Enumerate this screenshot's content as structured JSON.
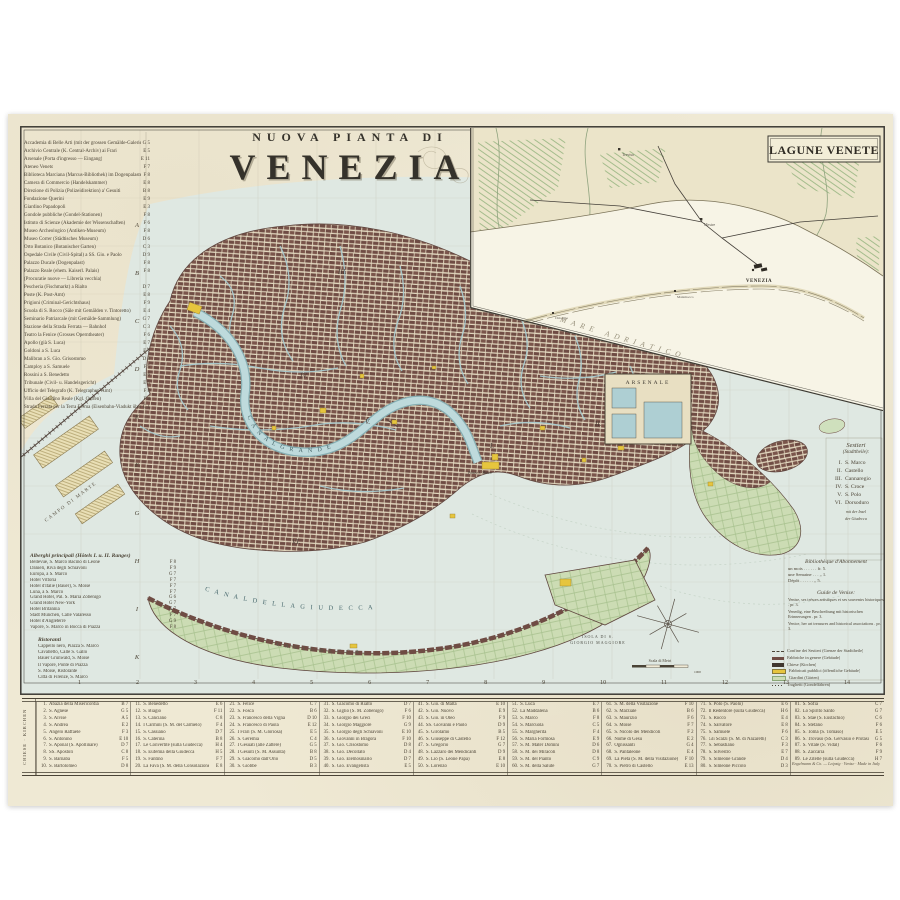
{
  "title": {
    "kicker": "NUOVA PIANTA DI",
    "name": "VENEZIA"
  },
  "inset": {
    "title": "LAGUNE VENETE",
    "sea": "MARE ADRIATICO",
    "city": "VENEZIA",
    "towns": [
      "Treviso",
      "Mestre",
      "Malamocco",
      "Chioggia"
    ]
  },
  "map": {
    "labels": {
      "canal_grande": "C A N A L   G R A N D E",
      "canal_giudecca": "C A N A L   D E L L A   G I U D E C C A",
      "giudecca": "L A   G I U D E C C A",
      "isola1": "ISOLA DI S.",
      "isola2": "GIORGIO MAGGIORE",
      "arsenale": "ARSENALE",
      "campo": "CAMPO DI MARTE",
      "piazza": "Piazza S. Marco",
      "scale": "Scala di Metri",
      "scale_val": "1000"
    },
    "sestieri_marks": {
      "s1": "I.",
      "s2": "II.",
      "s3": "III.",
      "s4": "IV.",
      "s5": "V.",
      "s6": "VI."
    }
  },
  "grid": {
    "numbers": [
      "1",
      "2",
      "3",
      "4",
      "5",
      "6",
      "7",
      "8",
      "9",
      "10",
      "11",
      "12",
      "13",
      "14"
    ],
    "letters": [
      "A",
      "B",
      "C",
      "D",
      "E",
      "F",
      "G",
      "H",
      "I",
      "K"
    ]
  },
  "index_left": {
    "rows": [
      {
        "name": "Accademia di Belle Arti (mit der grossen Gemälde-Galerie)",
        "ref": "G 5"
      },
      {
        "name": "Archivio Centrale (K. Central-Archiv) ai Frari",
        "ref": "E 5"
      },
      {
        "name": "Arsenale (Porta d'ingresso — Eingang)",
        "ref": "E 11"
      },
      {
        "name": "Ateneo Veneto",
        "ref": "F 7"
      },
      {
        "name": "Biblioteca Marciana (Marcus-Bibliothek) im Dogenpalaste",
        "ref": "F 8"
      },
      {
        "name": "Camera di Commercio (Handelskammer)",
        "ref": "E 8"
      },
      {
        "name": "Direzione di Polizia (Polizeidirektion) a' Gesuiti",
        "ref": "B 8"
      },
      {
        "name": "Fondazione Querini",
        "ref": "E 9"
      },
      {
        "name": "Giardino Papadopoli",
        "ref": "E 3"
      },
      {
        "name": "Gondole pubbliche (Gondel-Stationen)",
        "ref": "F 8"
      },
      {
        "name": "Istituto di Scienze (Akademie der Wissenschaften)",
        "ref": "F 6"
      },
      {
        "name": "Museo Archeologico (Antiken-Museum)",
        "ref": "F 8"
      },
      {
        "name": "Museo Correr (Städtisches Museum)",
        "ref": "D 6"
      },
      {
        "name": "Orto Botanico (Botanischer Garten)",
        "ref": "C 3"
      },
      {
        "name": "Ospedale Civile (Civil-Spital) a SS. Gio. e Paolo",
        "ref": "D 9"
      },
      {
        "name": "Palazzo Ducale (Dogenpalast)",
        "ref": "F 8"
      },
      {
        "name": "Palazzo Reale (ehem. Kaiserl. Palais)",
        "ref": "F 8"
      },
      {
        "name": "   (Procuratie nuove — Libreria vecchia)",
        "ref": ""
      },
      {
        "name": "Pescheria (Fischmarkt) a Rialto",
        "ref": "D 7"
      },
      {
        "name": "Poste (K. Post-Amt)",
        "ref": "E 8"
      },
      {
        "name": "Prigioni (Criminal-Gerichtshaus)",
        "ref": "F 9"
      },
      {
        "name": "Scuola di S. Rocco (Säle mit Gemälden v. Tintoretto)",
        "ref": "E 4"
      },
      {
        "name": "Seminario Patriarcale (mit Gemälde-Sammlung)",
        "ref": "G 7"
      },
      {
        "name": "Stazione della Strada Ferrata — Bahnhof",
        "ref": "C 3"
      },
      {
        "name": "Teatro la Fenice (Grosses Operntheater)",
        "ref": "F 6"
      },
      {
        "name": "   Apollo (già S. Luca)",
        "ref": "E 7"
      },
      {
        "name": "   Goldoni a S. Luca",
        "ref": "E 7"
      },
      {
        "name": "   Malibran a S. Gio. Grisostomo",
        "ref": "D 8"
      },
      {
        "name": "   Camploy a S. Samuele",
        "ref": "F 5"
      },
      {
        "name": "   Rossini a S. Benedetto",
        "ref": "E 6"
      },
      {
        "name": "Tribunale (Civil- u. Handelsgericht)",
        "ref": "E 5"
      },
      {
        "name": "Ufficio del Telegrafo (K. Telegraphen-Amt)",
        "ref": "F 8"
      },
      {
        "name": "Villa del Giardino Reale (Kgl. Garten)",
        "ref": "F 8"
      },
      {
        "name": "Strada Ferrata per la Terra Ferma (Eisenbahn-Viadukt über die Lagunen)",
        "ref": "C 1"
      }
    ]
  },
  "hotels": {
    "header": "Alberghi principali (Hôtels I. u. II. Ranges)",
    "rows": [
      {
        "name": "Bellevue, S. Marco Bacino di Leone",
        "ref": "F 8"
      },
      {
        "name": "Danieli, Riva degli Schiavoni",
        "ref": "F 9"
      },
      {
        "name": "Europa, a S. Marco",
        "ref": "G 7"
      },
      {
        "name": "Hôtel Vittoria",
        "ref": "F 7"
      },
      {
        "name": "Hôtel d'Italie (Bauer), S. Moisè",
        "ref": "F 7"
      },
      {
        "name": "Luna, a S. Marco",
        "ref": "F 7"
      },
      {
        "name": "Grand Hôtel, Pal. S. Maria Zobenigo",
        "ref": "G 6"
      },
      {
        "name": "Grand Hôtel New-York",
        "ref": "G 7"
      },
      {
        "name": "Hôtel Britannia",
        "ref": "G 7"
      },
      {
        "name": "Stadt München, Calle Valaresso",
        "ref": "F 7"
      },
      {
        "name": "Hôtel d'Angleterre",
        "ref": "G 9"
      },
      {
        "name": "Vapore, S. Marco in Bocca di Piazza",
        "ref": "F 8"
      }
    ]
  },
  "restaurants": {
    "header": "Ristoranti",
    "rows": [
      "Cappello nero, Piazza S. Marco",
      "Cavalletto, Calle S. Gallo",
      "Bauer Grünwald, S. Moisè",
      "Il Vapore, Ponte di Piazza",
      "S. Moisè, Ristorante",
      "Città di Firenze, S. Marco"
    ]
  },
  "sestieri": {
    "title": "Sestieri",
    "subtitle": "(Stadttheile):",
    "items": [
      {
        "num": "I.",
        "name": "S. Marco"
      },
      {
        "num": "II.",
        "name": "Castello"
      },
      {
        "num": "III.",
        "name": "Cannaregio"
      },
      {
        "num": "IV.",
        "name": "S. Croce"
      },
      {
        "num": "V.",
        "name": "S. Polo"
      },
      {
        "num": "VI.",
        "name": "Dorsoduro"
      }
    ],
    "note1": "mit der Insel",
    "note2": "der Giudecca"
  },
  "library": {
    "title": "Bibliothèque d'Abonnement",
    "rows": [
      "un mois . . . . . . fr. 5.",
      "une Semaine . . . „ 1.",
      "Dépôt . . . . . . „ 5."
    ]
  },
  "guide": {
    "title": "Guide de Venise:",
    "rows": [
      "Venise, ses trésors artistiques et ses souvenirs historiques . pr. 3.",
      "Venedig, eine Beschreibung mit historischen Erinnerungen . pr. 3.",
      "Venice, her art treasures and historical associations . pr. 3."
    ]
  },
  "legend": {
    "items": [
      {
        "sym": "dash",
        "label": "Confine dei Sestieri (Grenze der Stadttheile)"
      },
      {
        "sym": "block",
        "label": "Fabbriche in genere (Gebäude)"
      },
      {
        "sym": "church",
        "label": "Chiese (Kirchen)"
      },
      {
        "sym": "public",
        "label": "Fabbricati pubblici (öffentliche Gebäude)"
      },
      {
        "sym": "garden",
        "label": "Giardini (Gärten)"
      },
      {
        "sym": "dots",
        "label": "Traghetti (Gondelfähren)"
      }
    ]
  },
  "church_table": {
    "side_label": "CHIESE · KIRCHEN",
    "columns": [
      {
        "rows": [
          {
            "n": "1.",
            "name": "Abazia della Misericordia",
            "ref": "B 7"
          },
          {
            "n": "2.",
            "name": "S. Agnese",
            "ref": "G 5"
          },
          {
            "n": "3.",
            "name": "S. Alvise",
            "ref": "A 5"
          },
          {
            "n": "4.",
            "name": "S. Andrea",
            "ref": "E 2"
          },
          {
            "n": "5.",
            "name": "Angelo Raffaele",
            "ref": "F 3"
          },
          {
            "n": "6.",
            "name": "S. Antonino",
            "ref": "E 10"
          },
          {
            "n": "7.",
            "name": "S. Aponal (S. Apollinare)",
            "ref": "D 7"
          },
          {
            "n": "8.",
            "name": "SS. Apostoli",
            "ref": "C 8"
          },
          {
            "n": "9.",
            "name": "S. Barnaba",
            "ref": "F 5"
          },
          {
            "n": "10.",
            "name": "S. Bartolomeo",
            "ref": "D 8"
          }
        ]
      },
      {
        "rows": [
          {
            "n": "11.",
            "name": "S. Benedetto",
            "ref": "E 6"
          },
          {
            "n": "12.",
            "name": "S. Biagio",
            "ref": "F 11"
          },
          {
            "n": "13.",
            "name": "S. Canciano",
            "ref": "C 8"
          },
          {
            "n": "14.",
            "name": "I Carmini (S. M. del Carmelo)",
            "ref": "F 4"
          },
          {
            "n": "15.",
            "name": "S. Cassiano",
            "ref": "D 7"
          },
          {
            "n": "16.",
            "name": "S. Caterina",
            "ref": "B 8"
          },
          {
            "n": "17.",
            "name": "Le Convertite (sulla Giudecca)",
            "ref": "H 4"
          },
          {
            "n": "18.",
            "name": "S. Eufemia della Giudecca",
            "ref": "H 5"
          },
          {
            "n": "19.",
            "name": "S. Fantino",
            "ref": "F 7"
          },
          {
            "n": "20.",
            "name": "La Fava (S. M. della Consolazione)",
            "ref": "E 8"
          }
        ]
      },
      {
        "rows": [
          {
            "n": "21.",
            "name": "S. Felice",
            "ref": "C 7"
          },
          {
            "n": "22.",
            "name": "S. Fosca",
            "ref": "B 6"
          },
          {
            "n": "23.",
            "name": "S. Francesco della Vigna",
            "ref": "D 10"
          },
          {
            "n": "24.",
            "name": "S. Francesco di Paola",
            "ref": "E 12"
          },
          {
            "n": "25.",
            "name": "I Frari (S. M. Gloriosa)",
            "ref": "E 5"
          },
          {
            "n": "26.",
            "name": "S. Geremia",
            "ref": "C 4"
          },
          {
            "n": "27.",
            "name": "I Gesuati (alle Zattere)",
            "ref": "G 5"
          },
          {
            "n": "28.",
            "name": "I Gesuiti (S. M. Assunta)",
            "ref": "B 8"
          },
          {
            "n": "29.",
            "name": "S. Giacomo dall'Orio",
            "ref": "D 5"
          },
          {
            "n": "30.",
            "name": "S. Giobbe",
            "ref": "B 3"
          }
        ]
      },
      {
        "rows": [
          {
            "n": "31.",
            "name": "S. Giacomo di Rialto",
            "ref": "D 7"
          },
          {
            "n": "32.",
            "name": "S. Giglio (S. M. Zobenigo)",
            "ref": "F 6"
          },
          {
            "n": "33.",
            "name": "S. Giorgio dei Greci",
            "ref": "F 10"
          },
          {
            "n": "34.",
            "name": "S. Giorgio Maggiore",
            "ref": "G 9"
          },
          {
            "n": "35.",
            "name": "S. Giorgio degli Schiavoni",
            "ref": "E 10"
          },
          {
            "n": "36.",
            "name": "S. Giovanni in Bragora",
            "ref": "F 10"
          },
          {
            "n": "37.",
            "name": "S. Gio. Crisostomo",
            "ref": "D 8"
          },
          {
            "n": "38.",
            "name": "S. Gio. Decollato",
            "ref": "D 4"
          },
          {
            "n": "39.",
            "name": "S. Gio. Elemosinario",
            "ref": "D 7"
          },
          {
            "n": "40.",
            "name": "S. Gio. Evangelista",
            "ref": "E 5"
          }
        ]
      },
      {
        "rows": [
          {
            "n": "41.",
            "name": "S. Gio. di Malta",
            "ref": "E 10"
          },
          {
            "n": "42.",
            "name": "S. Gio. Nuovo",
            "ref": "E 9"
          },
          {
            "n": "43.",
            "name": "S. Gio. in Oleo",
            "ref": "F 9"
          },
          {
            "n": "44.",
            "name": "SS. Giovanni e Paolo",
            "ref": "D 9"
          },
          {
            "n": "45.",
            "name": "S. Girolamo",
            "ref": "B 5"
          },
          {
            "n": "46.",
            "name": "S. Giuseppe di Castello",
            "ref": "F 12"
          },
          {
            "n": "47.",
            "name": "S. Gregorio",
            "ref": "G 7"
          },
          {
            "n": "48.",
            "name": "S. Lazzaro dei Mendicanti",
            "ref": "D 9"
          },
          {
            "n": "49.",
            "name": "S. Lio (S. Leone Papa)",
            "ref": "E 8"
          },
          {
            "n": "50.",
            "name": "S. Lorenzo",
            "ref": "E 10"
          }
        ]
      },
      {
        "rows": [
          {
            "n": "51.",
            "name": "S. Luca",
            "ref": "E 7"
          },
          {
            "n": "52.",
            "name": "La Maddalena",
            "ref": "B 6"
          },
          {
            "n": "53.",
            "name": "S. Marco",
            "ref": "F 8"
          },
          {
            "n": "54.",
            "name": "S. Marcuola",
            "ref": "C 5"
          },
          {
            "n": "55.",
            "name": "S. Margherita",
            "ref": "F 4"
          },
          {
            "n": "56.",
            "name": "S. Maria Formosa",
            "ref": "E 9"
          },
          {
            "n": "57.",
            "name": "S. M. Mater Domini",
            "ref": "D 6"
          },
          {
            "n": "58.",
            "name": "S. M. dei Miracoli",
            "ref": "D 8"
          },
          {
            "n": "59.",
            "name": "S. M. del Pianto",
            "ref": "C 9"
          },
          {
            "n": "60.",
            "name": "S. M. della Salute",
            "ref": "G 7"
          }
        ]
      },
      {
        "rows": [
          {
            "n": "61.",
            "name": "S. M. della Visitazione",
            "ref": "F 10"
          },
          {
            "n": "62.",
            "name": "S. Marziale",
            "ref": "B 6"
          },
          {
            "n": "63.",
            "name": "S. Maurizio",
            "ref": "F 6"
          },
          {
            "n": "64.",
            "name": "S. Moisè",
            "ref": "F 7"
          },
          {
            "n": "65.",
            "name": "S. Nicolò dei Mendicoli",
            "ref": "F 2"
          },
          {
            "n": "66.",
            "name": "Nome di Gesù",
            "ref": "E 2"
          },
          {
            "n": "67.",
            "name": "Ognissanti",
            "ref": "G 4"
          },
          {
            "n": "68.",
            "name": "S. Pantaleone",
            "ref": "E 4"
          },
          {
            "n": "69.",
            "name": "La Pietà (S. M. della Visitazione)",
            "ref": "F 10"
          },
          {
            "n": "70.",
            "name": "S. Pietro di Castello",
            "ref": "E 13"
          }
        ]
      },
      {
        "rows": [
          {
            "n": "71.",
            "name": "S. Polo (S. Paolo)",
            "ref": "E 6"
          },
          {
            "n": "72.",
            "name": "Il Redentore (sulla Giudecca)",
            "ref": "H 6"
          },
          {
            "n": "73.",
            "name": "S. Rocco",
            "ref": "E 4"
          },
          {
            "n": "74.",
            "name": "S. Salvatore",
            "ref": "E 8"
          },
          {
            "n": "75.",
            "name": "S. Samuele",
            "ref": "F 6"
          },
          {
            "n": "76.",
            "name": "Gli Scalzi (S. M. di Nazareth)",
            "ref": "C 3"
          },
          {
            "n": "77.",
            "name": "S. Sebastiano",
            "ref": "F 3"
          },
          {
            "n": "78.",
            "name": "S. Silvestro",
            "ref": "E 7"
          },
          {
            "n": "79.",
            "name": "S. Simeone Grande",
            "ref": "D 4"
          },
          {
            "n": "80.",
            "name": "S. Simeone Piccolo",
            "ref": "D 3"
          }
        ]
      },
      {
        "rows": [
          {
            "n": "81.",
            "name": "S. Sofia",
            "ref": "C 7"
          },
          {
            "n": "82.",
            "name": "Lo Spirito Santo",
            "ref": "G 7"
          },
          {
            "n": "83.",
            "name": "S. Stae (S. Eustachio)",
            "ref": "C 6"
          },
          {
            "n": "84.",
            "name": "S. Stefano",
            "ref": "F 6"
          },
          {
            "n": "85.",
            "name": "S. Tomà (S. Tomaso)",
            "ref": "E 5"
          },
          {
            "n": "86.",
            "name": "S. Trovaso (SS. Gervasio e Protasio)",
            "ref": "G 5"
          },
          {
            "n": "87.",
            "name": "S. Vitale (S. Vidal)",
            "ref": "F 6"
          },
          {
            "n": "88.",
            "name": "S. Zaccaria",
            "ref": "F 9"
          },
          {
            "n": "89.",
            "name": "Le Zitelle (sulla Giudecca)",
            "ref": "H 7"
          }
        ]
      }
    ]
  },
  "imprint": "Engelmann & Co. — Leipzig · Venise · Made in Italy"
}
